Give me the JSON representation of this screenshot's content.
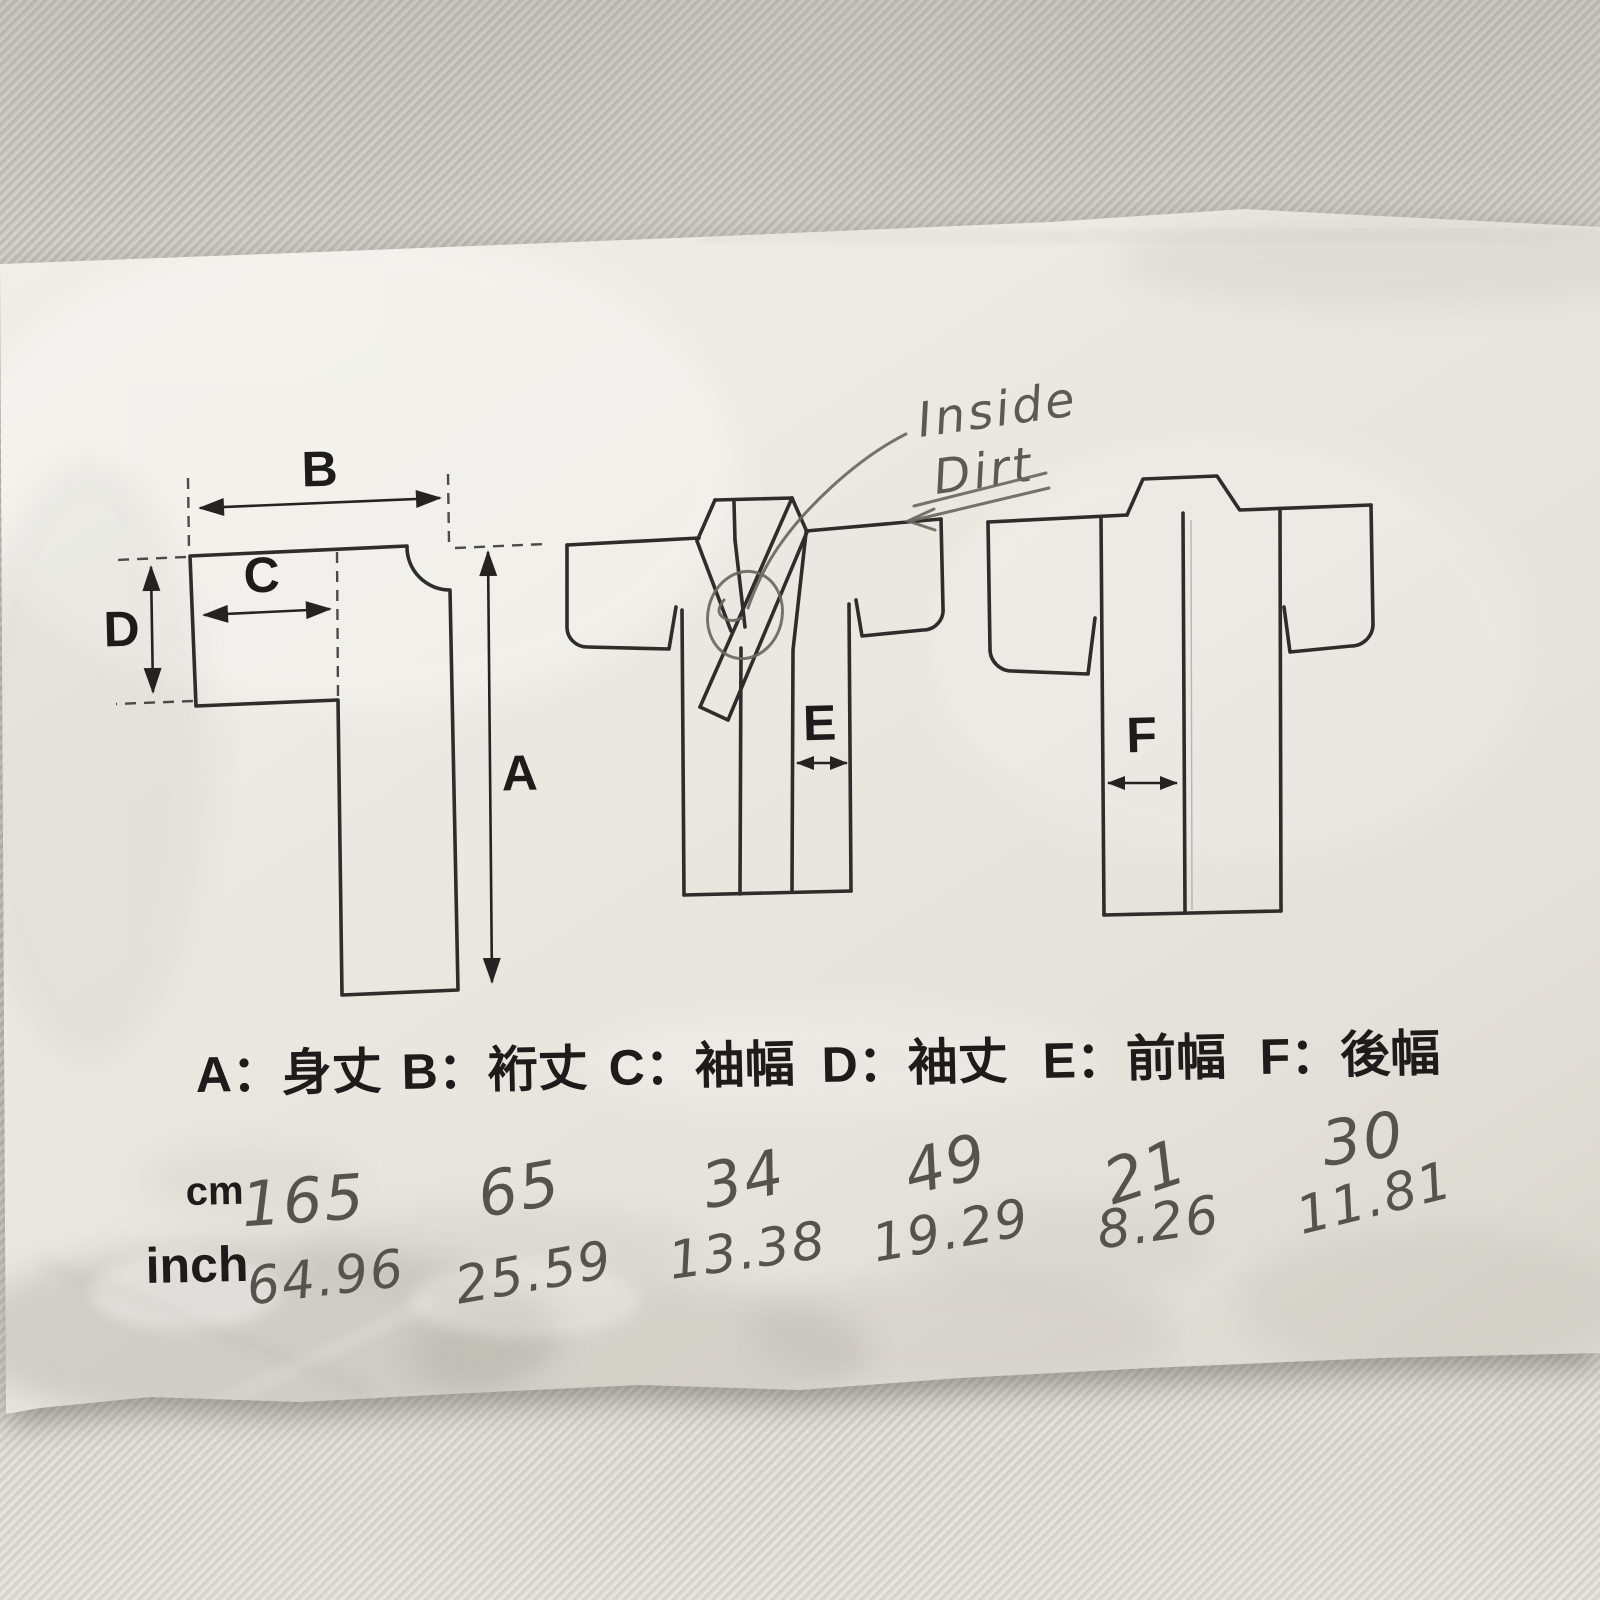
{
  "paper": {
    "handwritten_note": {
      "line1": "Inside",
      "line2": "Dirt"
    },
    "dim_letters": {
      "A": "A",
      "B": "B",
      "C": "C",
      "D": "D",
      "E": "E",
      "F": "F"
    },
    "legend_items": [
      "A：身丈",
      "B：裄丈",
      "C：袖幅",
      "D：袖丈",
      "E：前幅",
      "F：後幅"
    ],
    "unit_rows": {
      "cm": "cm",
      "inch": "inch"
    },
    "values_cm": [
      "165",
      "65",
      "34",
      "49",
      "21",
      "30"
    ],
    "values_inch": [
      "64.96",
      "25.59",
      "13.38",
      "19.29",
      "8.26",
      "11.81"
    ],
    "colors": {
      "paper": "#ebe9e2",
      "fabric": "#d3d0ca",
      "ink": "#2e2d2b",
      "pencil": "#5d5b56"
    }
  }
}
